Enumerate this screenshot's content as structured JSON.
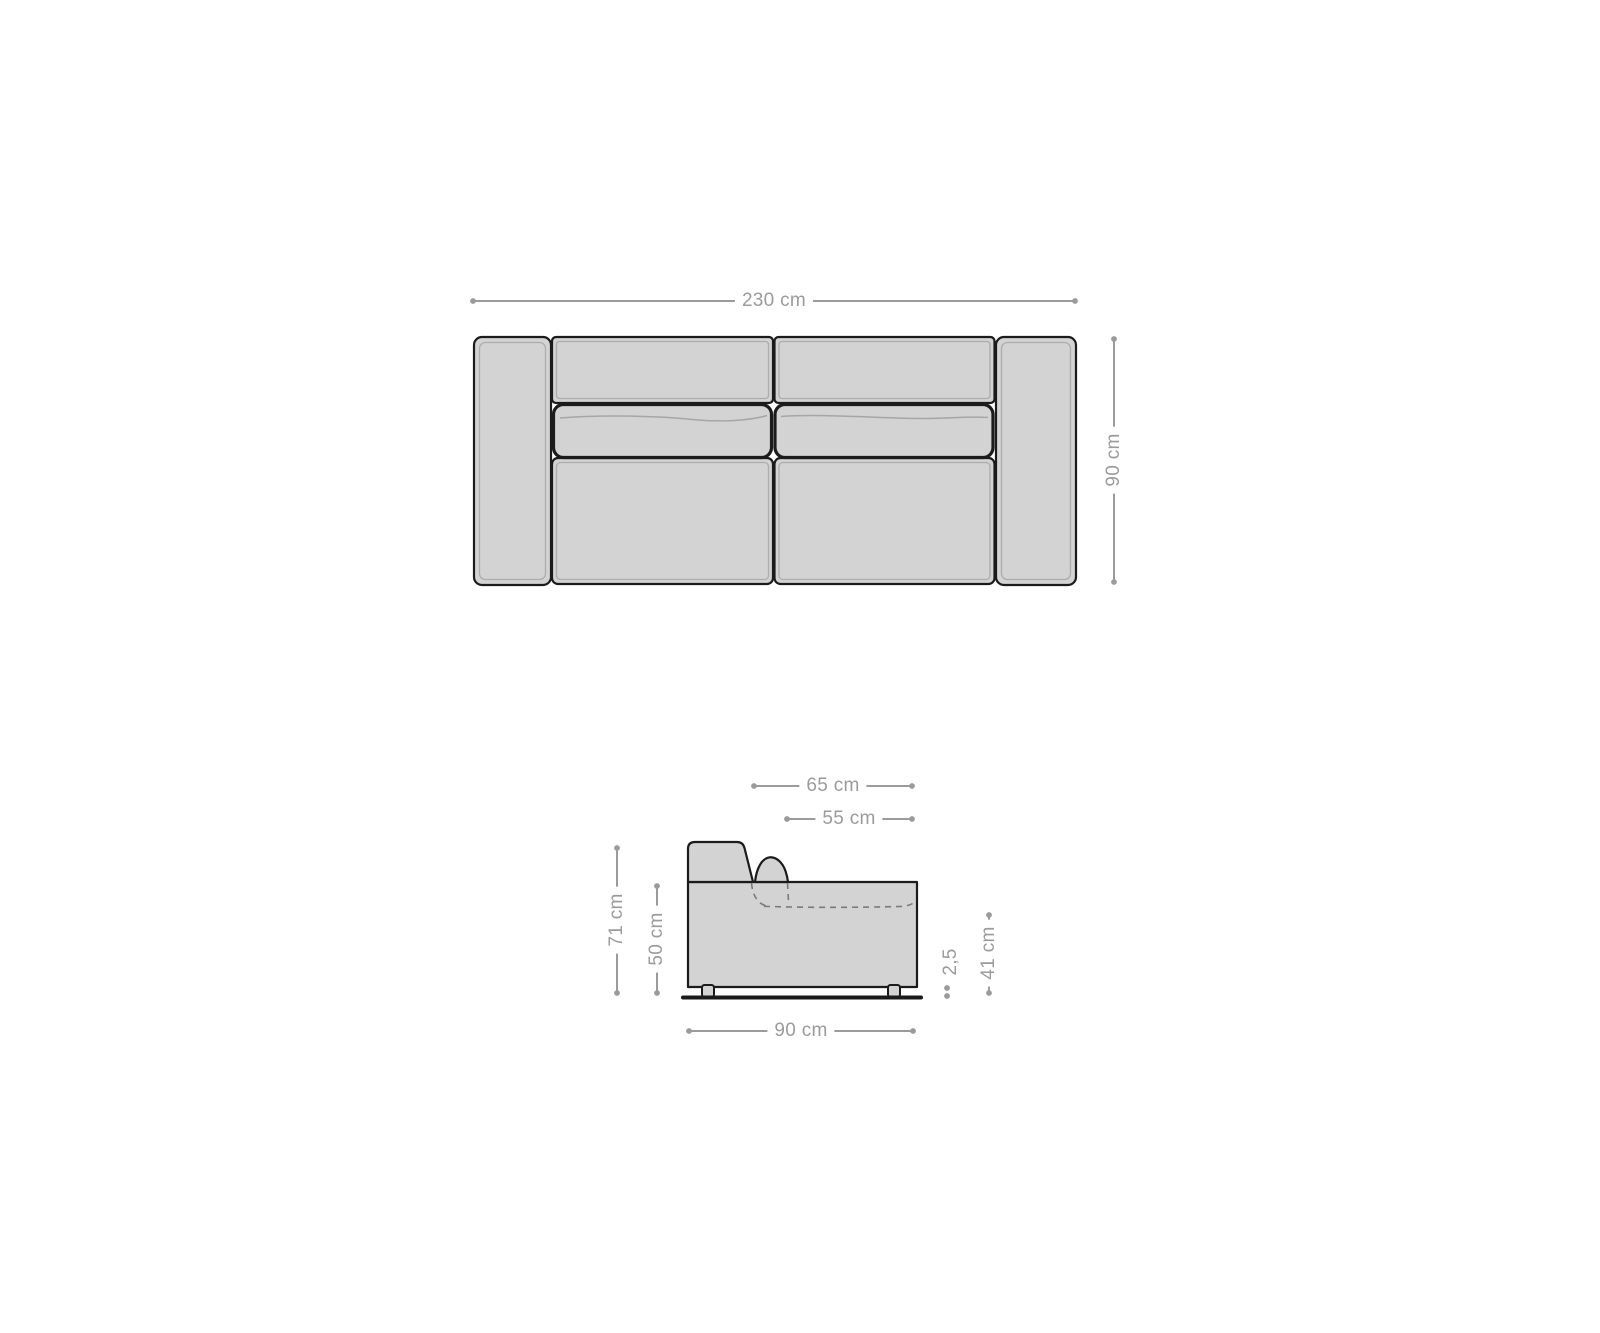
{
  "colors": {
    "background": "#ffffff",
    "outline": "#1b1b1b",
    "sofa_fill": "#d2d3d2",
    "inner_line": "#a6a6a6",
    "dashed_line": "#7a7a7a",
    "dimension": "#9b9b9b"
  },
  "top_view": {
    "overall_width": "230 cm",
    "overall_depth": "90 cm"
  },
  "side_view": {
    "depth_with_back_cushion": "65 cm",
    "seat_depth": "55 cm",
    "total_height": "71 cm",
    "armrest_height": "50 cm",
    "leg_height": "2,5",
    "seat_height": "41 cm",
    "total_depth": "90 cm"
  }
}
